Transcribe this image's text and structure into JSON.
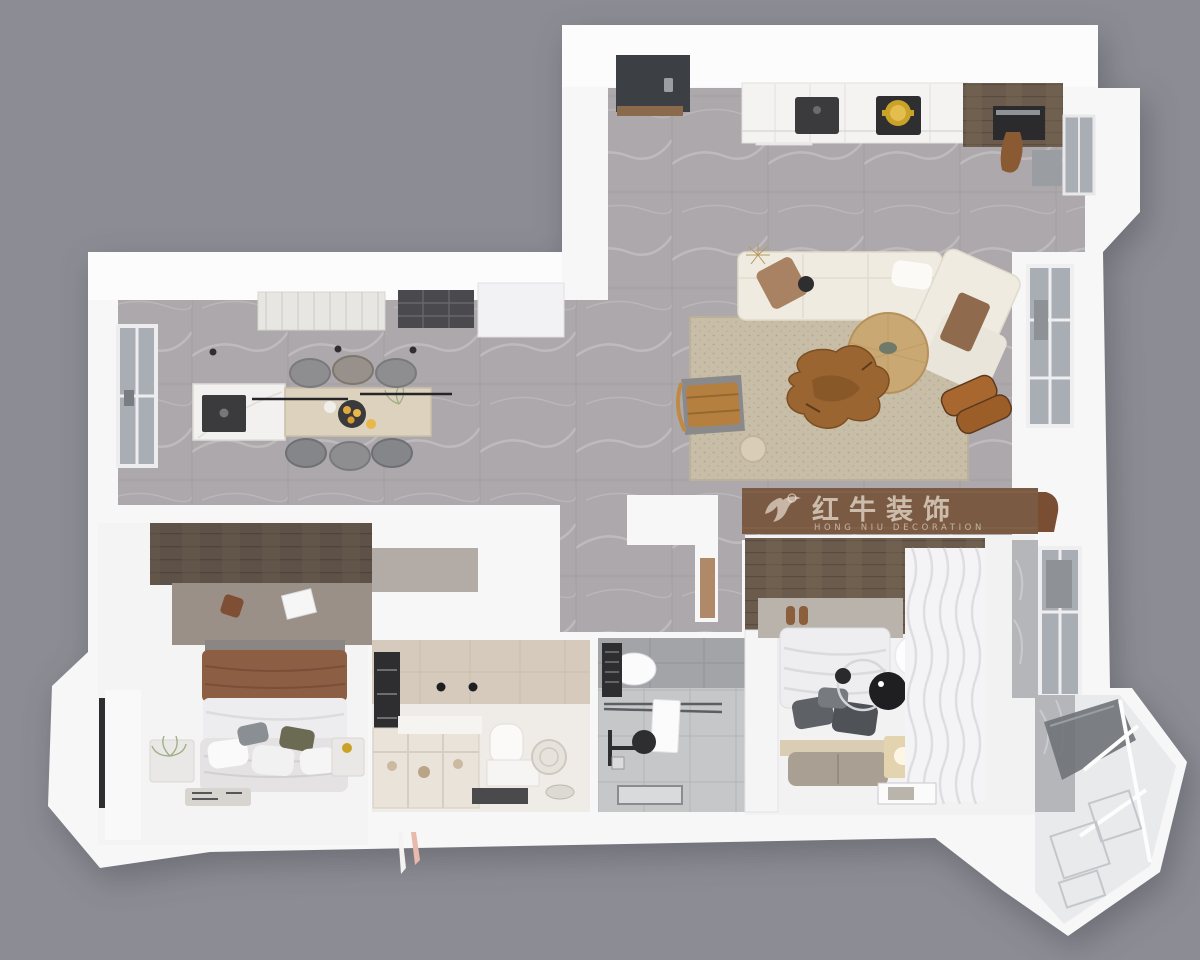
{
  "watermark": {
    "brand_cn": "红牛装饰",
    "brand_en": "HONG NIU DECORATION",
    "logo": "bull-swoosh-icon",
    "band_color": "#7A5A42",
    "text_color": "rgba(255,248,238,0.6)"
  },
  "palette": {
    "background": "#8C8C94",
    "walls": "#F7F7F8",
    "floor_tile": "#ADA8AB",
    "living_rug": "#C8BEA7",
    "wood_accent_wall": "#5E5248",
    "wardrobe_top_band": "#7A5A42",
    "dining_table_wood": "#DCD2BE",
    "island_marble": "#F2F1EF",
    "sofa_cream": "#EFEBE1",
    "round_table_wood": "#C9A873",
    "root_table_wood": "#9A6531",
    "leather_chair": "#B5803F",
    "bath_beige": "#D5CABB",
    "bath_gray": "#A3A4A7",
    "entry_door": "#3C3F43",
    "brass_accent": "#C9A227"
  },
  "scene": {
    "type": "3d-floorplan-top-down-render",
    "rooms": [
      {
        "name": "entry",
        "objects": [
          "dark-entry-door",
          "wood-threshold",
          "shoe-shelf"
        ]
      },
      {
        "name": "kitchen",
        "objects": [
          "white-cabinet-run",
          "dark-sink",
          "cooktop",
          "gold-pot",
          "dark-wood-tall-cabinet",
          "built-in-oven",
          "window"
        ]
      },
      {
        "name": "living-room",
        "objects": [
          "cream-sectional-sofa",
          "angled-chaise",
          "beige-area-rug",
          "round-wood-coffee-table",
          "root-wood-side-table",
          "leather-safari-chair",
          "brown-lounge-chair",
          "travertine-stool",
          "window-desk",
          "tall-window"
        ]
      },
      {
        "name": "dining-area",
        "objects": [
          "marble-island-with-sink",
          "wood-dining-table",
          "six-dining-chairs",
          "fruit-plate",
          "linear-black-pendants",
          "ceiling-light-panel",
          "ceiling-grille",
          "side-window",
          "range-hood-box"
        ]
      },
      {
        "name": "master-bedroom",
        "objects": [
          "wood-accent-headboard-wall",
          "gray-rug",
          "double-bed-brown-white",
          "pillows",
          "nightstand-with-plant",
          "nightstand-right",
          "foot-tray",
          "sheer-curtain-window"
        ]
      },
      {
        "name": "walk-in-bathroom",
        "objects": [
          "beige-tile-walls",
          "storage-shelving-bins",
          "wall-hung-toilet",
          "vanity-box",
          "cylindrical-heater",
          "dark-window",
          "dark-floor-mat"
        ]
      },
      {
        "name": "hall-bathroom",
        "objects": [
          "gray-tile-walls",
          "toilet",
          "glass-shower-screen",
          "white-towel",
          "black-shower-set",
          "floor-drain",
          "storage-caddy"
        ]
      },
      {
        "name": "bedroom-2",
        "objects": [
          "wood-floor-band",
          "white-bed",
          "dark-gray-pillows",
          "foot-bench",
          "white-wave-curtains",
          "globe-pendant-lamp",
          "black-disc-lamp",
          "lit-nightstand",
          "slippers",
          "art-frame",
          "white-wardrobe",
          "marble-window-wall"
        ]
      },
      {
        "name": "bay-window",
        "objects": [
          "angled-glazing-panel",
          "paneled-white-floor",
          "gray-marble-wall",
          "window-mullions"
        ]
      },
      {
        "name": "hallway",
        "objects": [
          "l-shaped-wall",
          "wood-niche-edge",
          "hanging-towels-white-pink"
        ]
      }
    ]
  }
}
